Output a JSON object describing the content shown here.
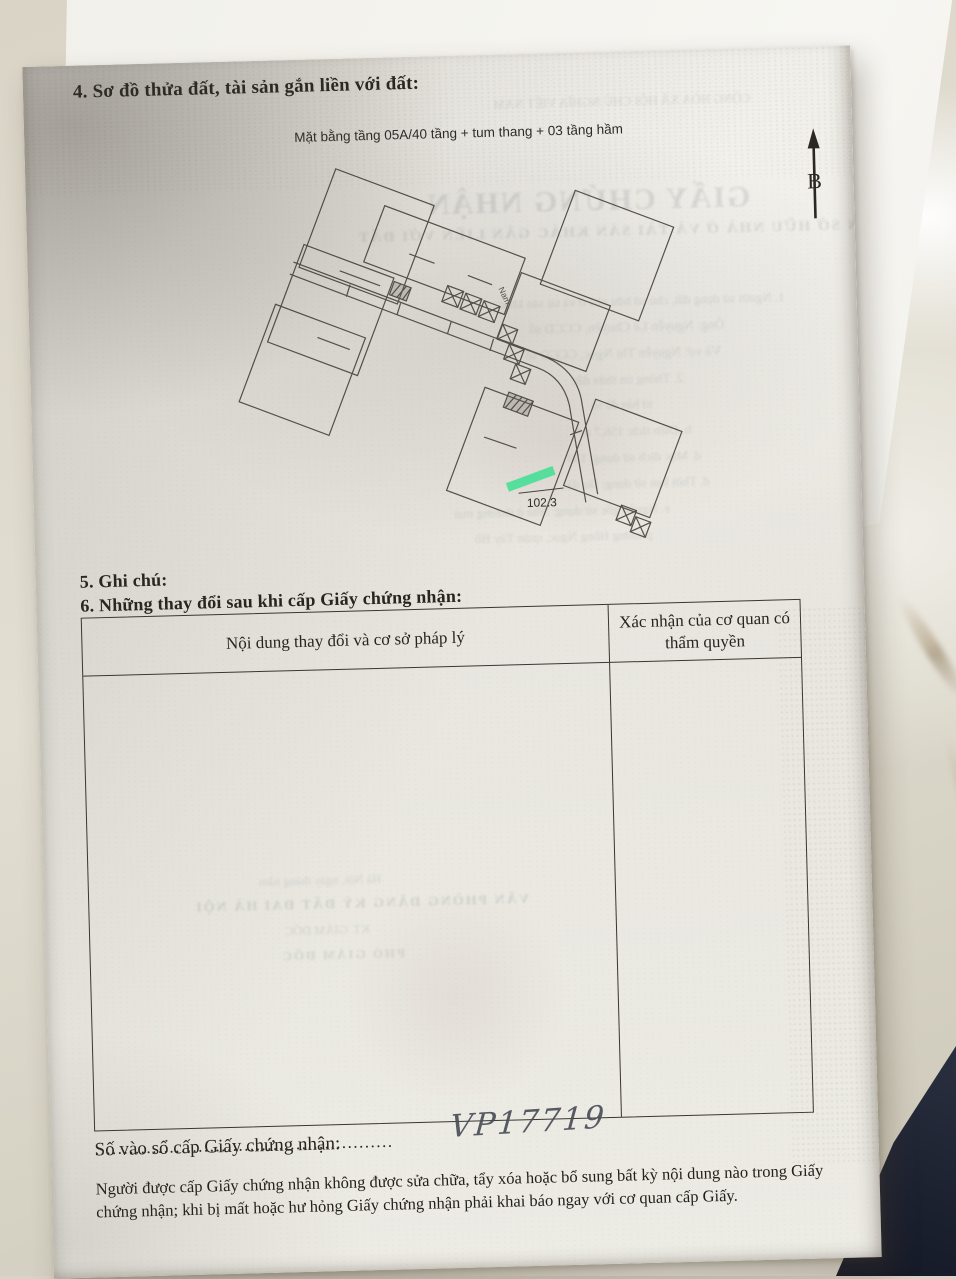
{
  "page": {
    "section4_title": "4. Sơ đồ thửa đất, tài sản gắn liền với đất:",
    "plan": {
      "caption": "Mặt bằng tầng 05A/40 tầng + tum thang + 03 tầng hầm",
      "north_label": "B",
      "corridor_label": "Nam",
      "highlighted_unit_area": "102.3",
      "highlight_color": "#3ce695"
    },
    "section5_title": "5. Ghi chú:",
    "section6_title": "6. Những thay đổi sau khi cấp Giấy chứng nhận:",
    "table": {
      "col1_header": "Nội dung thay đổi và cơ sở pháp lý",
      "col2_header": "Xác nhận của cơ quan có thẩm quyền"
    },
    "registry": {
      "label": "Số vào sổ cấp Giấy chứng nhận:",
      "dots": "....................................................",
      "handwritten_number": "VP17719"
    },
    "footer_note": "Người được cấp Giấy chứng nhận không được sửa chữa, tẩy xóa hoặc bổ sung bất kỳ nội dung nào trong Giấy chứng nhận; khi bị mất hoặc hư hỏng Giấy chứng nhận phải khai báo ngay với cơ quan cấp Giấy."
  },
  "bleedthrough": {
    "lines": [
      {
        "text": "CỘNG HÒA XÃ HỘI CHỦ NGHĨA VIỆT NAM"
      },
      {
        "text": "GIẤY CHỨNG NHẬN"
      },
      {
        "text": "QUYỀN SỬ DỤNG ĐẤT, QUYỀN SỞ HỮU NHÀ Ở VÀ TÀI SẢN KHÁC GẮN LIỀN VỚI ĐẤT"
      },
      {
        "text": "1. Người sử dụng đất, chủ sở hữu nhà ở và tài sản khác"
      },
      {
        "text": "Ông: Nguyễn Lê Chuyên, CCCD số"
      },
      {
        "text": "Và vợ: Nguyễn Thị Ngọc, CCCD số"
      },
      {
        "text": "2. Thông tin thửa đất:"
      },
      {
        "text": "tờ bản đồ số"
      },
      {
        "text": "b. Diện tích: 156,7 m²"
      },
      {
        "text": "d. Mục đích sử dụng: 150"
      },
      {
        "text": "đ. Thời hạn sử dụng: lâu dài"
      },
      {
        "text": "e. Nguồn gốc sử dụng: Nhà ở thương mại"
      },
      {
        "text": "phường Hồng Ngọc, quận Tây Hồ"
      },
      {
        "text": "Hà Nội, ngày      tháng      năm"
      },
      {
        "text": "VĂN PHÒNG ĐĂNG KÝ ĐẤT ĐAI HÀ NỘI"
      },
      {
        "text": "KT. GIÁM ĐỐC"
      },
      {
        "text": "PHÓ GIÁM ĐỐC"
      }
    ]
  },
  "colors": {
    "highlight_green": "#3ce695",
    "paper": "#ebe9e2",
    "ink": "#27241f",
    "marble": "#d9d4c6",
    "navy_object": "#1c2130"
  }
}
